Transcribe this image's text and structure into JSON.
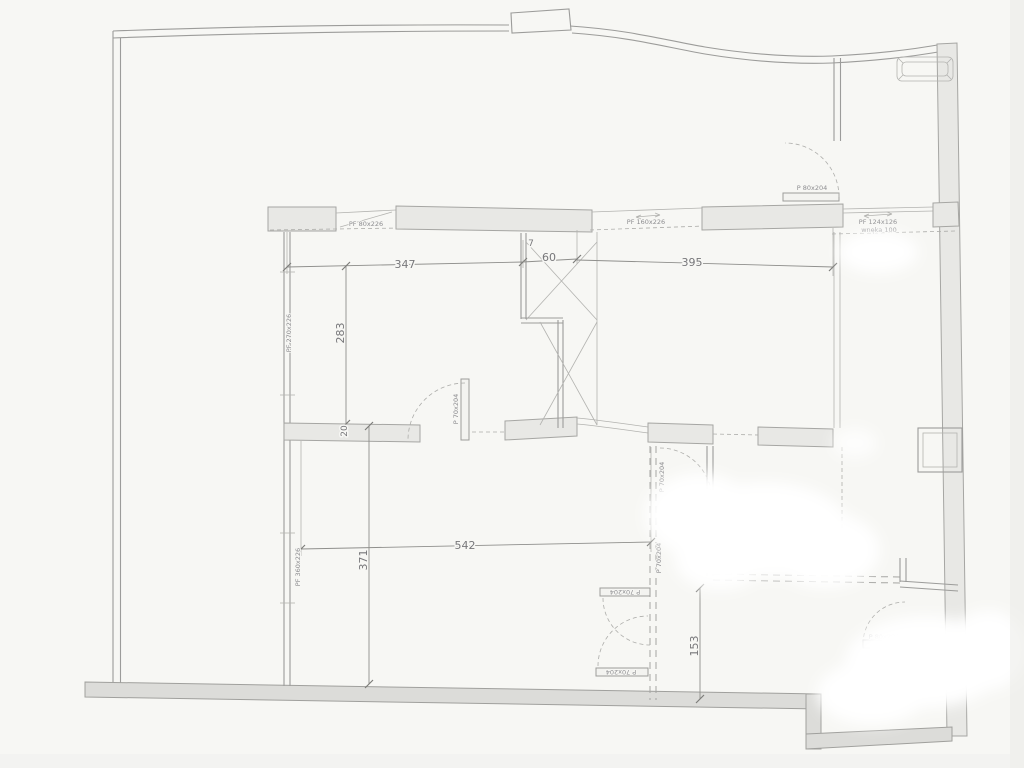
{
  "plan": {
    "dims": {
      "w_main": "347",
      "offset": "7",
      "w_col": "60",
      "w_right": "395",
      "h_room": "283",
      "wall_thick": "20",
      "w_bottom": "542",
      "h_bottom": "371",
      "h_bath": "153"
    },
    "windows": {
      "top_left": "PF 80x226",
      "top_mid": "PF 160x226",
      "top_right": "PF 124x126",
      "niche": "wnęka 100",
      "left_upper": "PF 270x226",
      "left_lower": "PF 360x226"
    },
    "doors": {
      "top_right": "P 80x204",
      "mid": "P 70x204",
      "corridor_upper": "P 70x204",
      "corridor_lower": "P 70x204",
      "bottom_1": "P 70x204",
      "bottom_2": "P 70x204",
      "bath": "P 80x204"
    },
    "colors": {
      "paper": "#f7f7f4",
      "wall_fill": "#e8e8e5",
      "wall_dark": "#dcdcd9",
      "line": "#9c9c9a",
      "dim_text": "#77777a"
    }
  }
}
